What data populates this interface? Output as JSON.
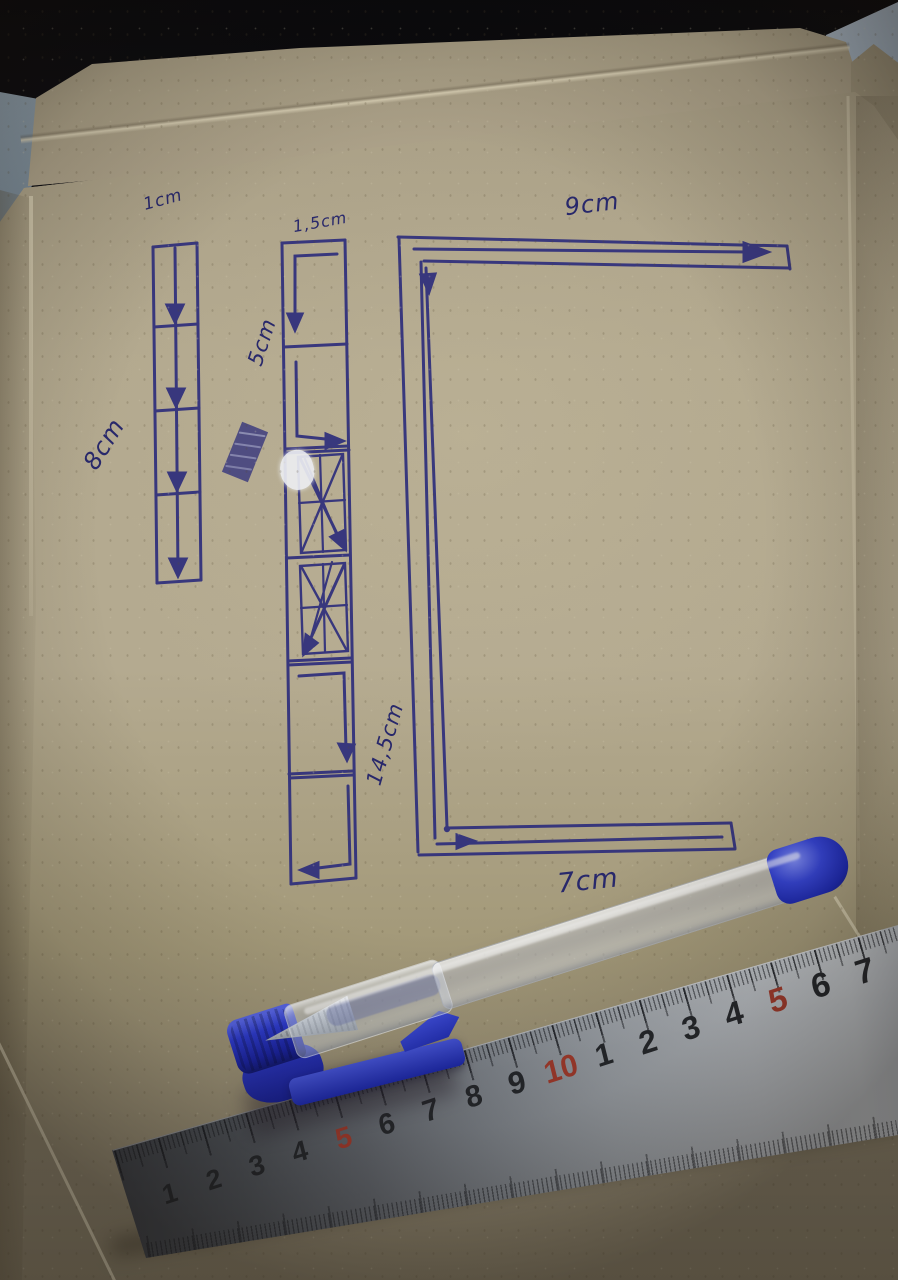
{
  "scene": {
    "type": "photograph",
    "description": "Inside of an opened cardboard box with hand-drawn measurement sketches in blue ballpoint pen, a transparent gel pen with blue cap, and a steel ruler",
    "ink_color": "#2e2e7c"
  },
  "sketch": {
    "labels": {
      "strip1_width": "1cm",
      "strip1_length": "8cm",
      "strip2_width": "1,5cm",
      "strip2_segment": "5cm",
      "strip2_length": "14,5cm",
      "bracket_top": "9cm",
      "bracket_bottom": "7cm"
    }
  },
  "ruler": {
    "unit_numbers": [
      "1",
      "2",
      "3",
      "4",
      "5",
      "6",
      "7",
      "8",
      "9",
      "10",
      "1",
      "2",
      "3",
      "4",
      "5",
      "6",
      "7"
    ],
    "number_color": "#23262b",
    "highlight_color": "#a23a2c",
    "metal_light": "#c2c7cc",
    "metal_dark": "#383c43"
  },
  "pen": {
    "body": "transparent",
    "cap_color": "#2b39cc"
  },
  "colors": {
    "cardboard": "#b2a88e",
    "cardboard_dark": "#8f8670",
    "background_dark": "#0c0c10",
    "wall_blue": "#9fb0bf"
  }
}
